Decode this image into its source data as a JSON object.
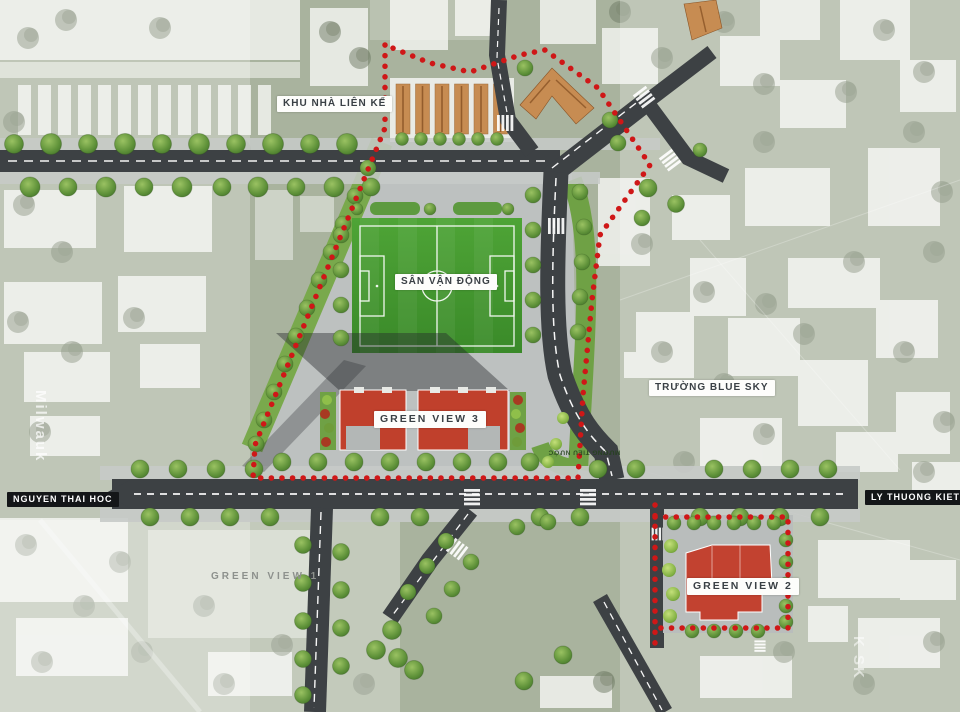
{
  "labels": {
    "khu_nha_lien_ke": "KHU NHÀ LIÊN KẾ",
    "san_van_dong": "SÂN VẬN ĐỘNG",
    "green_view_3": "GREEN VIEW 3",
    "truong_blue_sky": "TRƯỜNG BLUE SKY",
    "nguyen_thai_hoc": "NGUYEN THAI HOC",
    "ly_thuong_kiet": "LY THUONG KIET",
    "green_view_1": "GREEN VIEW 1",
    "green_view_2": "GREEN VIEW 2",
    "muong_tieu_nuoc": "MƯƠNG TIÊU NƯỚC"
  },
  "watermarks": {
    "left": "Milwauk",
    "right": "K SK"
  },
  "colors": {
    "boundary_red": "#cf1717",
    "building_red": "#c0402c",
    "rowhouse_orange": "#c78c52",
    "field_green": "#49a233",
    "lawn_green": "#6fa145",
    "road_dark": "#3d4144",
    "plaza_gray": "#bdc1c0",
    "base_green": "#a9b39e"
  }
}
